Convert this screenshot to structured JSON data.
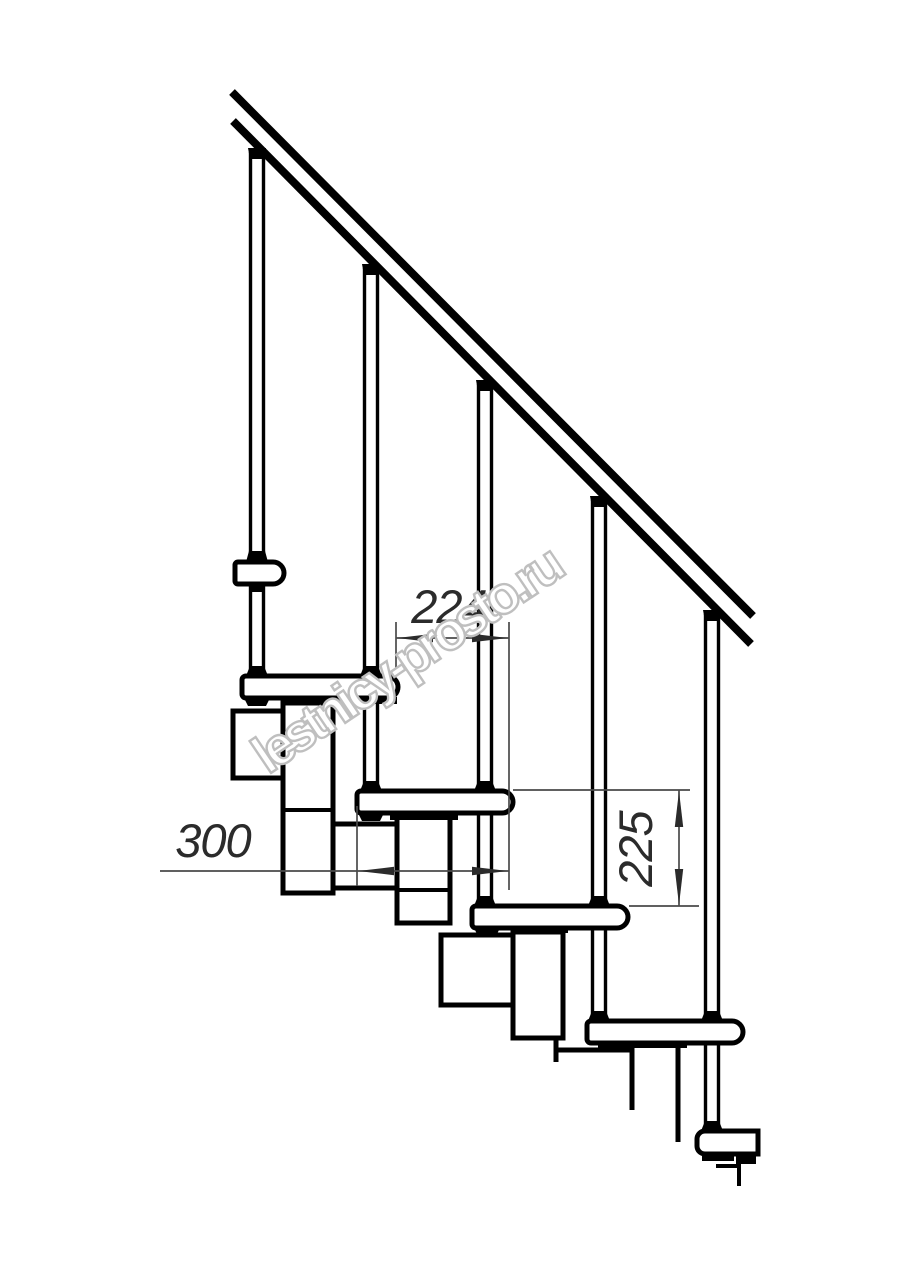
{
  "drawing": {
    "watermark_text": "lestnicy-prosto.ru",
    "dimensions": {
      "step_going": {
        "value": "224"
      },
      "tread_depth": {
        "value": "300"
      },
      "step_rise": {
        "value": "225"
      }
    },
    "colors": {
      "line": "#000000",
      "dim-line": "#4a4a4a",
      "dim-text": "#2b2b2b",
      "watermark-stroke": "#bfbfbf",
      "watermark-fill": "#ffffff",
      "background": "#ffffff"
    }
  }
}
